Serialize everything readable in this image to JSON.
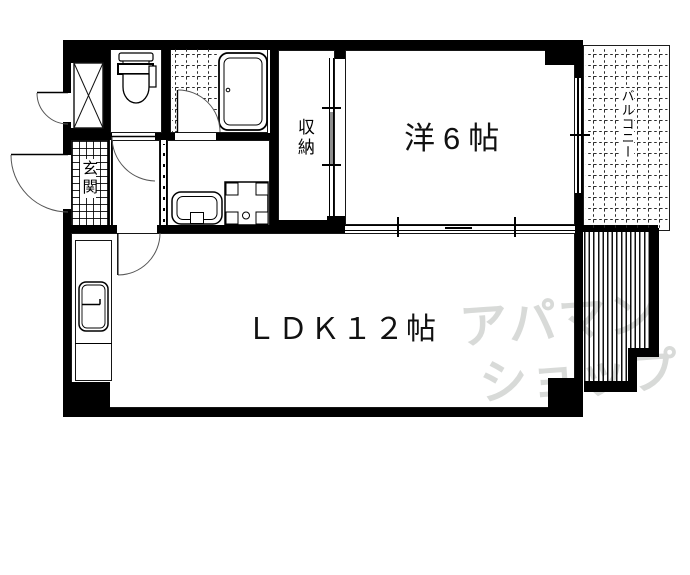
{
  "floorplan": {
    "labels": {
      "western_room": "洋6帖",
      "ldk": "ＬＤＫ１２帖",
      "storage": "収納",
      "entrance": "玄関",
      "balcony": "バルコニー"
    },
    "watermark": {
      "line1": "アパマン",
      "line2": "ショップ",
      "color": "#d8dad8"
    },
    "colors": {
      "wall": "#000000",
      "background": "#ffffff",
      "hatch": "#101010"
    }
  }
}
